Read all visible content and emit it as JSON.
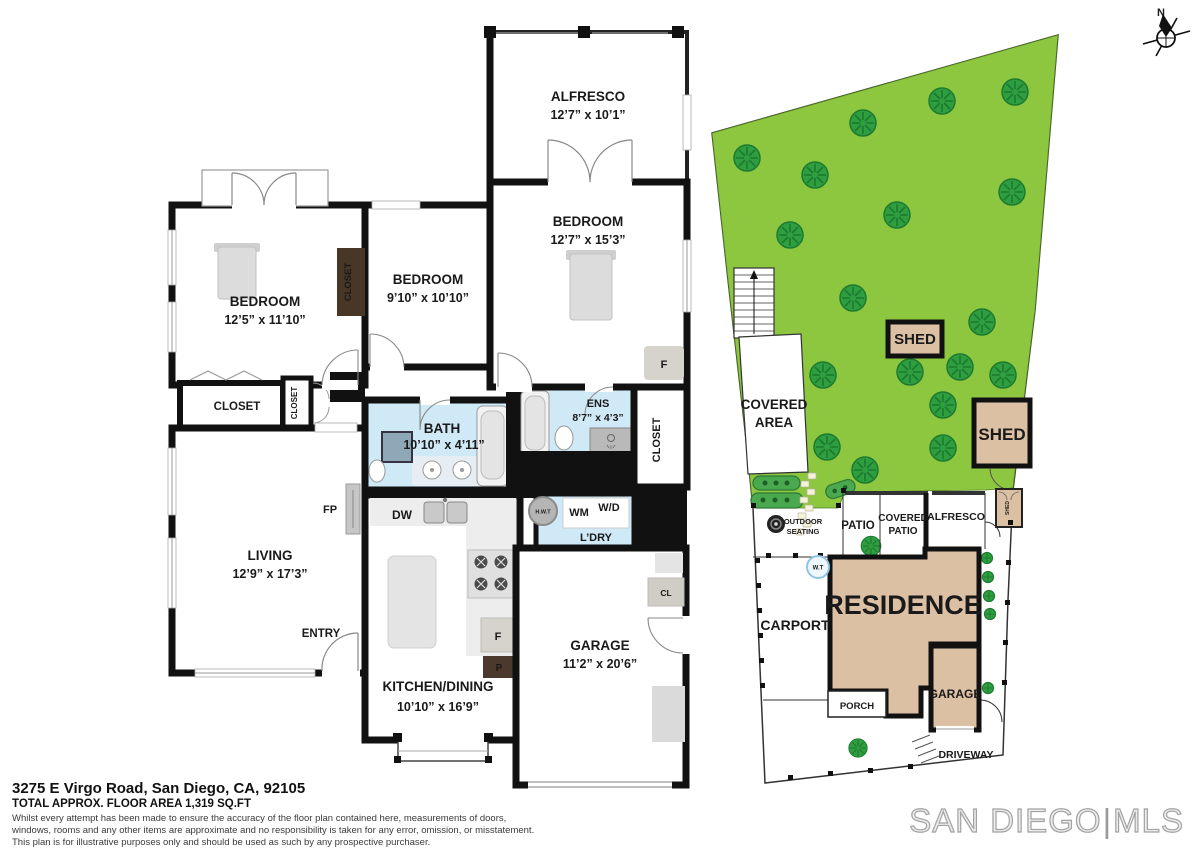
{
  "title_block": {
    "address": "3275 E Virgo Road, San Diego, CA, 92105",
    "floor_area": "TOTAL APPROX. FLOOR AREA 1,319 SQ.FT",
    "disclaimer_line1": "Whilst every attempt has been made to ensure the accuracy of the floor plan contained here, measurements of doors,",
    "disclaimer_line2": "windows, rooms and any other items are approximate and no responsibility is taken for any error, omission, or misstatement.",
    "disclaimer_line3": "This plan is for illustrative purposes only and should be used as such by any prospective purchaser."
  },
  "brand": {
    "left": "SAN DIEGO",
    "divider": "|",
    "right": "MLS"
  },
  "compass": {
    "label": "N"
  },
  "floorplan": {
    "alfresco": {
      "name": "ALFRESCO",
      "dims": "12’7” x 10’1”"
    },
    "bedroom_right": {
      "name": "BEDROOM",
      "dims": "12’7” x 15’3”"
    },
    "bedroom_left": {
      "name": "BEDROOM",
      "dims": "12’5” x 11’10”"
    },
    "bedroom_mid": {
      "name": "BEDROOM",
      "dims": "9’10” x 10’10”"
    },
    "bath": {
      "name": "BATH",
      "dims": "10’10” x 4’11”"
    },
    "ens": {
      "name": "ENS",
      "dims": "8’7” x 4’3”"
    },
    "living": {
      "name": "LIVING",
      "dims": "12’9” x 17’3”"
    },
    "kitchen": {
      "name": "KITCHEN/DINING",
      "dims": "10’10” x 16’9”"
    },
    "garage": {
      "name": "GARAGE",
      "dims": "11’2” x 20’6”"
    },
    "labels": {
      "closet": "CLOSET",
      "fp": "FP",
      "entry": "ENTRY",
      "dw": "DW",
      "wm": "WM",
      "wd": "W/D",
      "ldry": "L’DRY",
      "hwt": "H.W.T",
      "fridge": "F",
      "pantry": "P",
      "cl": "CL"
    }
  },
  "siteplan": {
    "labels": {
      "shed": "SHED",
      "covered_line1": "COVERED",
      "covered_line2": "AREA",
      "outdoor_line1": "OUTDOOR",
      "outdoor_line2": "SEATING",
      "patio": "PATIO",
      "covered_patio_line1": "COVERED",
      "covered_patio_line2": "PATIO",
      "alfresco": "ALFRESCO",
      "wt": "W.T",
      "residence": "RESIDENCE",
      "carport": "CARPORT",
      "porch": "PORCH",
      "garage": "GARAGE",
      "driveway": "DRIVEWAY"
    }
  }
}
